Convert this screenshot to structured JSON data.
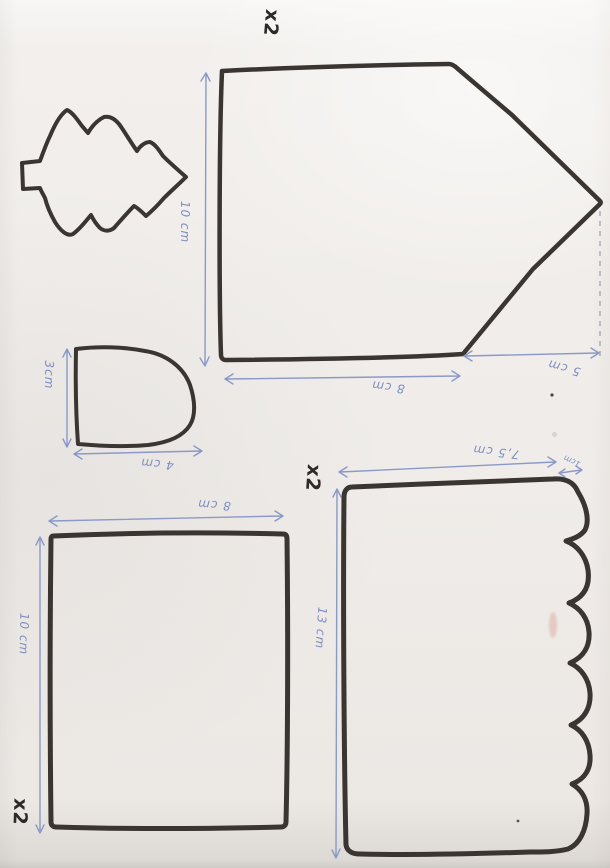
{
  "sheet": {
    "description_note": "",
    "colors": {
      "ink": "#3a3531",
      "pencil_blue": "#7d8ec2",
      "paper": "#efece9"
    }
  },
  "pieces": {
    "gable": {
      "copies": "x2",
      "dim_height": "10 cm",
      "dim_width": "8 cm",
      "dim_peak": "5 cm"
    },
    "dome": {
      "dim_height": "3cm",
      "dim_width": "4 cm"
    },
    "rectangle": {
      "copies": "x2",
      "dim_width": "8 cm",
      "dim_height": "10 cm"
    },
    "scalloped": {
      "copies": "x2",
      "dim_width": "7,5 cm",
      "dim_scallop": "1cm",
      "dim_height": "13 cm"
    }
  }
}
